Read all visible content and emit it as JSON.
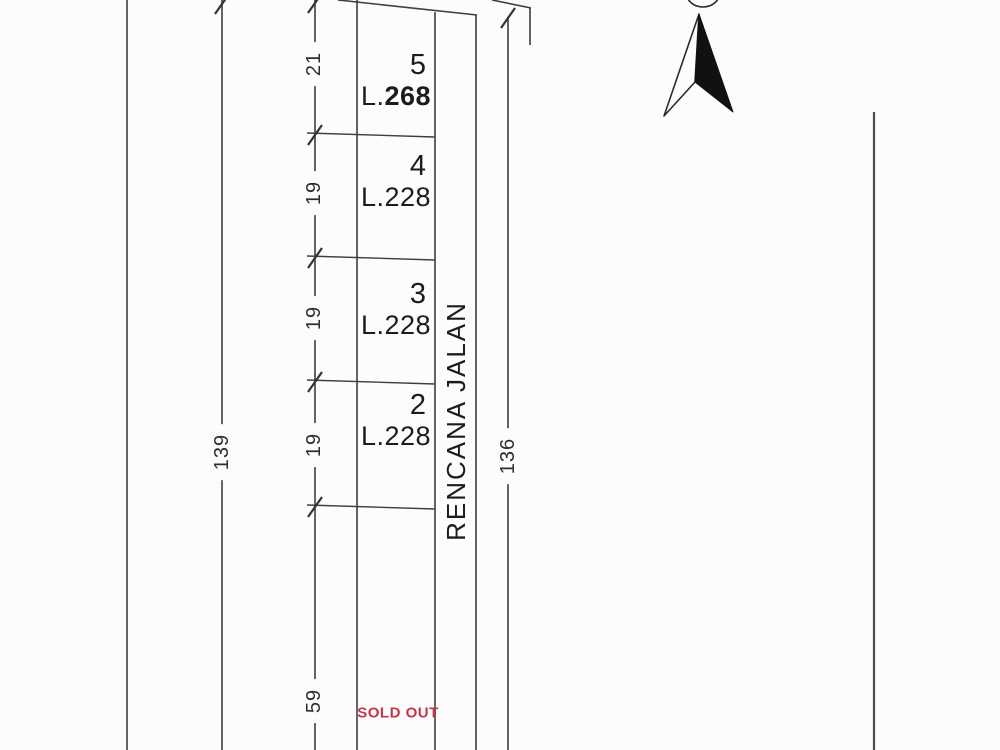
{
  "title": "Land subdivision site plan",
  "plots": [
    {
      "number": "5",
      "area_prefix": "L.",
      "area_value": "268"
    },
    {
      "number": "4",
      "area_prefix": "L.",
      "area_value": "228"
    },
    {
      "number": "3",
      "area_prefix": "L.",
      "area_value": "228"
    },
    {
      "number": "2",
      "area_prefix": "L.",
      "area_value": "228"
    }
  ],
  "road": {
    "label": "RENCANA JALAN"
  },
  "status": {
    "sold_out_label": "SOLD OUT",
    "color": "#c9334a"
  },
  "dimensions": {
    "left_total": "139",
    "right_total": "136",
    "segment_top": "21",
    "segment_2": "19",
    "segment_3": "19",
    "segment_4": "19",
    "segment_bottom": "59"
  },
  "icons": {
    "north_arrow": "north-arrow"
  },
  "colors": {
    "line": "#3e3e3e",
    "background": "#fcfcfc",
    "sold_out": "#c9334a"
  }
}
